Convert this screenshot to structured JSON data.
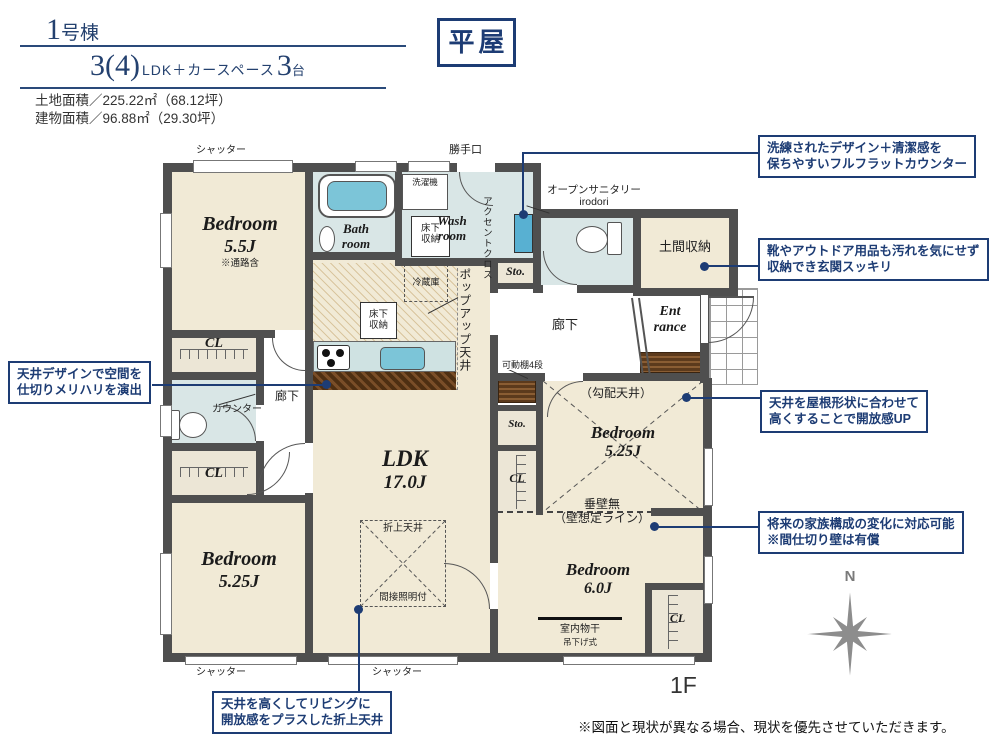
{
  "header": {
    "unit_num": "1",
    "unit_suffix": "号棟",
    "plan_main": "3(4)",
    "plan_mid": "LDK＋カースペース",
    "plan_num2": "3",
    "plan_tail": "台",
    "land_area": "土地面積／225.22㎡（68.12坪）",
    "building_area": "建物面積／96.88㎡（29.30坪）",
    "badge": "平屋"
  },
  "rooms": {
    "bedroom55": {
      "name": "Bedroom",
      "size": "5.5J",
      "note": "※通路含"
    },
    "bath": {
      "l1": "Bath",
      "l2": "room"
    },
    "wash": {
      "l1": "Wash",
      "l2": "room"
    },
    "ldk": {
      "name": "LDK",
      "size": "17.0J"
    },
    "bedroom525L": {
      "name": "Bedroom",
      "size": "5.25J"
    },
    "bedroom525R": {
      "name": "Bedroom",
      "size": "5.25J"
    },
    "bedroom6": {
      "name": "Bedroom",
      "size": "6.0J"
    },
    "entrance": {
      "l1": "Ent",
      "l2": "rance"
    },
    "doma": "土間収納",
    "hall": "廊下",
    "sto": "Sto.",
    "cl": "CL"
  },
  "labels": {
    "shutter": "シャッター",
    "backdoor": "勝手口",
    "washer": "洗濯機",
    "underfloor1": "床下",
    "underfloor2": "収納",
    "accent": "アクセントクロス",
    "sanitary1": "オープンサニタリー",
    "sanitary2": "irodori",
    "shelf": "可動棚4段",
    "fridge": "冷蔵庫",
    "popup": "ポップアップ天井",
    "coffered": "折上天井",
    "indirect": "間接照明付",
    "counter": "カウンター",
    "slope": "（勾配天井）",
    "nowall1": "垂壁無",
    "nowall2": "（壁想定ライン）",
    "drying1": "室内物干",
    "drying2": "吊下げ式",
    "north": "N"
  },
  "callouts": {
    "counter": [
      "洗練されたデザイン＋清潔感を",
      "保ちやすいフルフラットカウンター"
    ],
    "doma": [
      "靴やアウトドア用品も汚れを気にせず",
      "収納でき玄関スッキリ"
    ],
    "ceiling_zone": [
      "天井デザインで空間を",
      "仕切りメリハリを演出"
    ],
    "slope": [
      "天井を屋根形状に合わせて",
      "高くすることで開放感UP"
    ],
    "partition": [
      "将来の家族構成の変化に対応可能",
      "※間仕切り壁は有償"
    ],
    "coffered": [
      "天井を高くしてリビングに",
      "開放感をプラスした折上天井"
    ]
  },
  "footer": {
    "floor": "1F",
    "disclaimer": "※図面と現状が異なる場合、現状を優先させていただきます。"
  }
}
